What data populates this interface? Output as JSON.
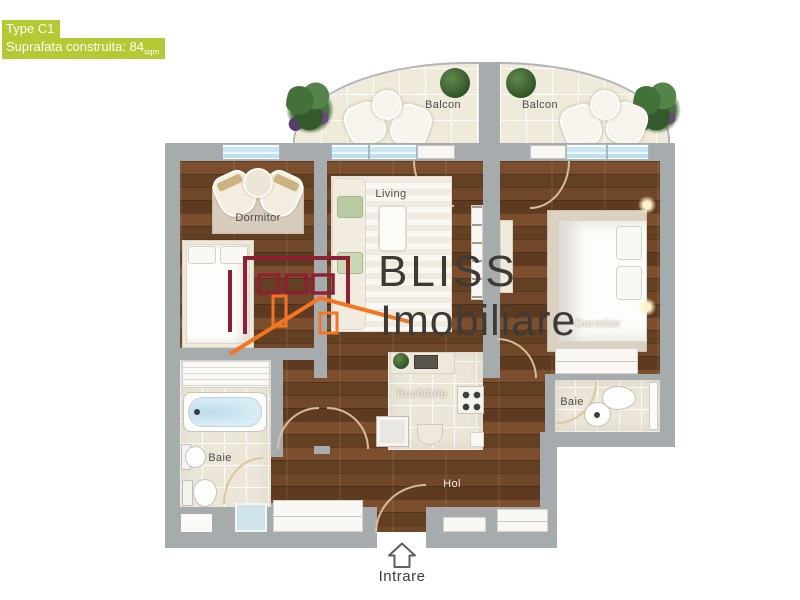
{
  "header": {
    "type_label": "Type C1",
    "area_label": "Suprafata construita: 84",
    "area_unit": "sqm"
  },
  "brand": {
    "name": "BLISS",
    "subtitle": "Imobiliare"
  },
  "rooms": {
    "balcon_left": "Balcon",
    "balcon_right": "Balcon",
    "living": "Living",
    "dormitor_left": "Dormitor",
    "dormitor_right": "Dormitor",
    "bucatarie": "Bucătărie",
    "baie_left": "Baie",
    "baie_right": "Baie",
    "hol": "Hol"
  },
  "entrance": {
    "label": "Intrare"
  },
  "colors": {
    "accent_green": "#b5c934",
    "wall_gray": "#a6abae",
    "wood_brown": "#6d4628",
    "tile_cream": "#ebe6d8",
    "window_blue": "#cbe7f4",
    "logo_red": "#8e2033",
    "logo_orange": "#f47421",
    "logo_text": "#403a36"
  },
  "icons": [
    "plant-cluster-icon",
    "potted-plant-icon",
    "chair-icon",
    "bistro-table-icon",
    "sofa-icon",
    "coffee-table-icon",
    "bed-icon",
    "nightstand-lamp-icon",
    "tv-cabinet-icon",
    "stove-icon",
    "kitchen-sink-icon",
    "washbasin-icon",
    "bathtub-icon",
    "pedestal-sink-icon",
    "toilet-icon",
    "shower-icon",
    "wardrobe-icon",
    "radiator-icon",
    "entrance-arrow-icon",
    "logo-building-icon"
  ]
}
